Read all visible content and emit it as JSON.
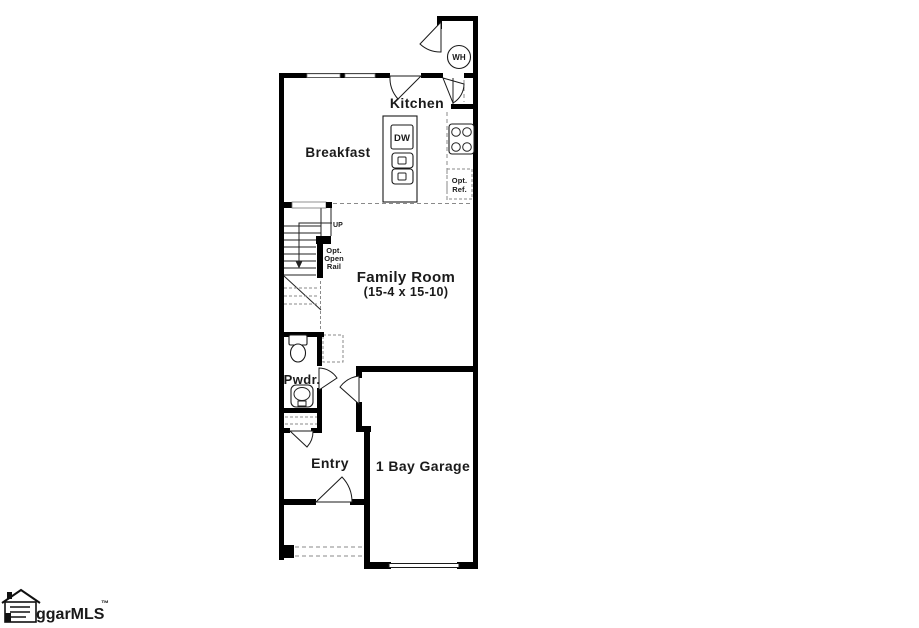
{
  "colors": {
    "wall": "#000000",
    "background": "#ffffff",
    "dashed_line": "#8a8a8a"
  },
  "rooms": {
    "kitchen": {
      "label": "Kitchen"
    },
    "breakfast": {
      "label": "Breakfast"
    },
    "family_room": {
      "label": "Family Room",
      "dimensions": "(15-4 x 15-10)"
    },
    "powder": {
      "label": "Pwdr."
    },
    "entry": {
      "label": "Entry"
    },
    "garage": {
      "label": "1 Bay Garage"
    }
  },
  "fixtures": {
    "water_heater": {
      "label": "WH"
    },
    "dishwasher": {
      "label": "DW"
    },
    "optional_refrigerator": {
      "line1": "Opt.",
      "line2": "Ref."
    }
  },
  "stairs": {
    "direction": "UP",
    "optional_rail": {
      "line1": "Opt.",
      "line2": "Open",
      "line3": "Rail"
    }
  },
  "watermark": {
    "brand": "ggarMLS",
    "trademark": "™"
  }
}
